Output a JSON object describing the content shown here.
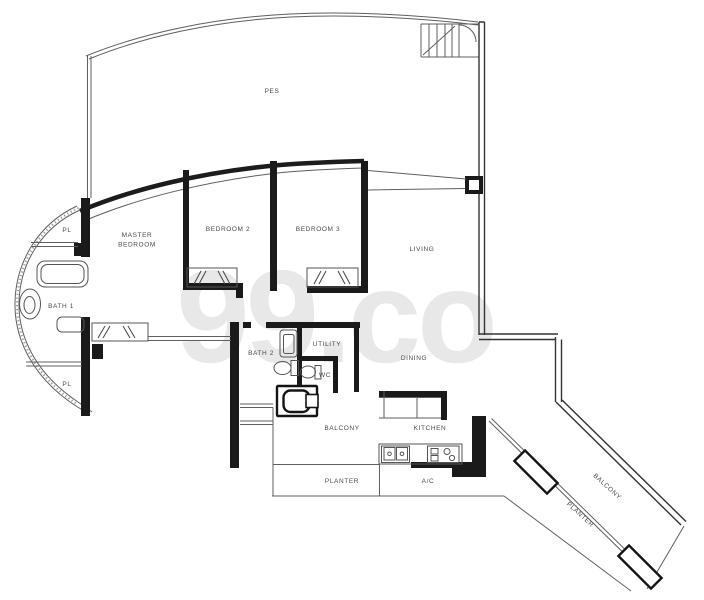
{
  "watermark": {
    "text": "99.co"
  },
  "colors": {
    "wall": "#1a1a1a",
    "thin_line": "#5f5f5f",
    "label": "#4a4a4a",
    "watermark": "#dadada"
  },
  "floorplan": {
    "labels": [
      {
        "id": "pes",
        "lines": [
          "PES"
        ],
        "x": 272,
        "y": 93,
        "rot": 0
      },
      {
        "id": "pl-upper",
        "lines": [
          "PL"
        ],
        "x": 67,
        "y": 232,
        "rot": 0
      },
      {
        "id": "master-bedroom",
        "lines": [
          "MASTER",
          "BEDROOM"
        ],
        "x": 137,
        "y": 237,
        "rot": 0
      },
      {
        "id": "bedroom-2",
        "lines": [
          "BEDROOM 2"
        ],
        "x": 228,
        "y": 231,
        "rot": 0
      },
      {
        "id": "bedroom-3",
        "lines": [
          "BEDROOM 3"
        ],
        "x": 318,
        "y": 231,
        "rot": 0
      },
      {
        "id": "living",
        "lines": [
          "LIVING"
        ],
        "x": 422,
        "y": 251,
        "rot": 0
      },
      {
        "id": "bath-1",
        "lines": [
          "BATH 1"
        ],
        "x": 61,
        "y": 308,
        "rot": 0
      },
      {
        "id": "pl-lower",
        "lines": [
          "PL"
        ],
        "x": 67,
        "y": 386,
        "rot": 0
      },
      {
        "id": "bath-2",
        "lines": [
          "BATH 2"
        ],
        "x": 261,
        "y": 355,
        "rot": 0
      },
      {
        "id": "utility",
        "lines": [
          "UTILITY"
        ],
        "x": 327,
        "y": 346,
        "rot": 0
      },
      {
        "id": "wc",
        "lines": [
          "WC"
        ],
        "x": 325,
        "y": 377,
        "rot": 0
      },
      {
        "id": "dining",
        "lines": [
          "DINING"
        ],
        "x": 414,
        "y": 360,
        "rot": 0
      },
      {
        "id": "balcony",
        "lines": [
          "BALCONY"
        ],
        "x": 342,
        "y": 430,
        "rot": 0
      },
      {
        "id": "kitchen",
        "lines": [
          "KITCHEN"
        ],
        "x": 430,
        "y": 430,
        "rot": 0
      },
      {
        "id": "planter",
        "lines": [
          "PLANTER"
        ],
        "x": 342,
        "y": 483,
        "rot": 0
      },
      {
        "id": "ac-ledge",
        "lines": [
          "A/C"
        ],
        "x": 428,
        "y": 483,
        "rot": 0
      },
      {
        "id": "balcony-diagonal",
        "lines": [
          "BALCONY"
        ],
        "x": 606,
        "y": 488,
        "rot": 42
      },
      {
        "id": "planter-diagonal",
        "lines": [
          "PLANTER"
        ],
        "x": 579,
        "y": 516,
        "rot": 42
      }
    ]
  }
}
